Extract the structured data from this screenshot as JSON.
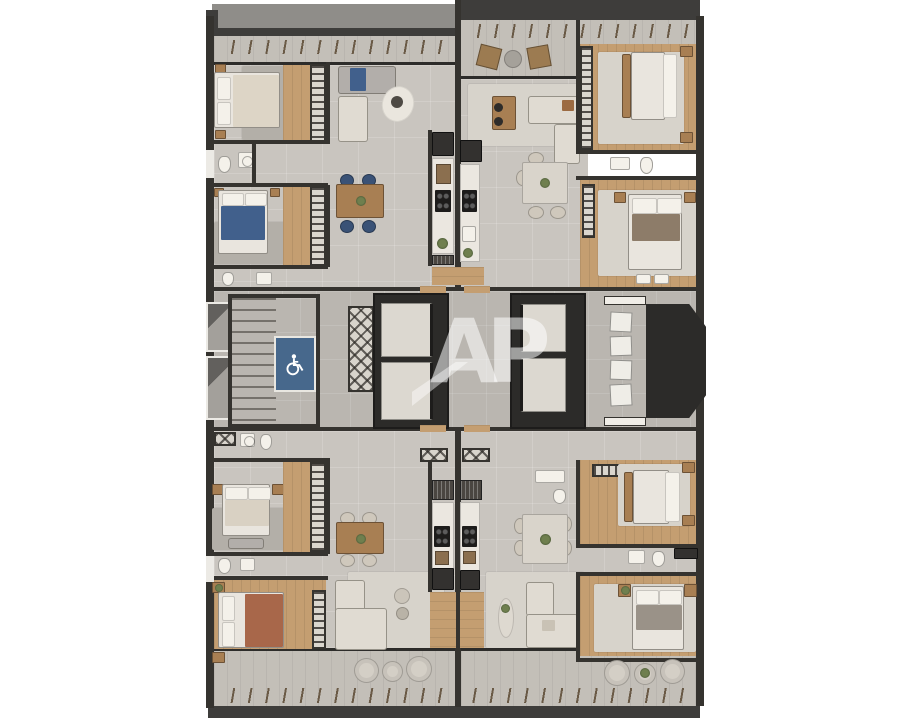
{
  "watermark": {
    "text": "AP"
  },
  "colors": {
    "background": "#ffffff",
    "wall": "#35332f",
    "wall_dark": "#2c2b29",
    "roof_left": "#8f8d89",
    "roof_right": "#3e3d3b",
    "tile": "#c9c5bf",
    "tile_dark": "#bab6b0",
    "wood": "#c49e71",
    "wood_dark": "#a87f53",
    "deck": "#c3bfb8",
    "rug": "#d7d3cb",
    "sofa": "#e0dbd2",
    "sofa_grey": "#b2aeaa",
    "bed_white": "#e9e5de",
    "accent_blue": "#41608c",
    "platform_blue": "#47688c",
    "chair_blue": "#3a5276",
    "rust": "#a8674a",
    "appliance_dark": "#33312f",
    "counter": "#ebe7e0",
    "marble": "#d9d4cb",
    "plant_green": "#6f7f4e"
  },
  "floorplan": {
    "type": "residential-floor-plan-top-view",
    "units": [
      "upper-left",
      "upper-right",
      "lower-left",
      "lower-right"
    ],
    "unit_features": [
      "bedrooms",
      "bathrooms",
      "kitchen",
      "living-dining",
      "balcony"
    ],
    "core": {
      "staircase": true,
      "accessible_lift_platform": true,
      "elevators": 4,
      "ac_condenser_units": 4,
      "service_shafts": true
    }
  }
}
